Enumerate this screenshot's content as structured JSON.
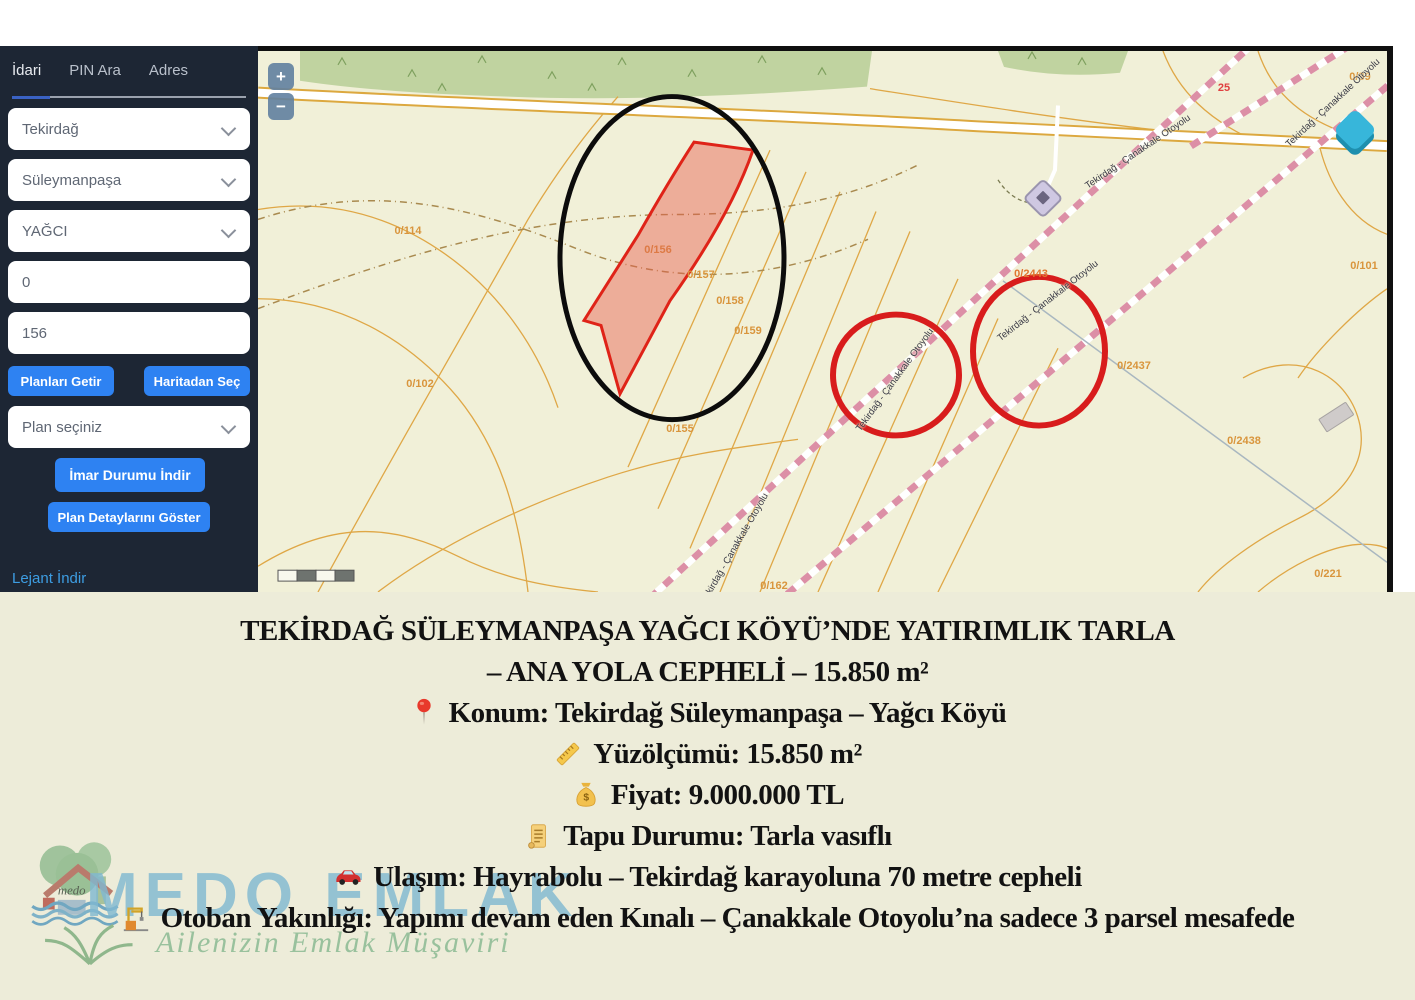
{
  "sidebar": {
    "tabs": [
      {
        "label": "İdari",
        "active": true
      },
      {
        "label": "PIN Ara",
        "active": false
      },
      {
        "label": "Adres",
        "active": false
      }
    ],
    "selects": [
      {
        "value": "Tekirdağ"
      },
      {
        "value": "Süleymanpaşa"
      },
      {
        "value": "YAĞCI"
      }
    ],
    "inputs": [
      {
        "value": "0"
      },
      {
        "value": "156"
      }
    ],
    "buttons": {
      "get_plans": "Planları Getir",
      "pick_from_map": "Haritadan Seç",
      "plan_select_placeholder": "Plan seçiniz",
      "download_zoning": "İmar Durumu İndir",
      "show_plan_details": "Plan Detaylarını Göster",
      "download_legend": "Lejant İndir"
    }
  },
  "map": {
    "controls": {
      "zoom_in": "+",
      "zoom_out": "−"
    },
    "parcel_labels": [
      {
        "text": "0/114",
        "x": 150,
        "y": 180
      },
      {
        "text": "0/102",
        "x": 162,
        "y": 333
      },
      {
        "text": "0/156",
        "x": 400,
        "y": 199,
        "color": "#dd7a45"
      },
      {
        "text": "0/157",
        "x": 443,
        "y": 224
      },
      {
        "text": "0/158",
        "x": 472,
        "y": 250
      },
      {
        "text": "0/159",
        "x": 490,
        "y": 280
      },
      {
        "text": "0/155",
        "x": 422,
        "y": 378
      },
      {
        "text": "0/162",
        "x": 516,
        "y": 535
      },
      {
        "text": "0/2443",
        "x": 773,
        "y": 223,
        "color": "#e0762f"
      },
      {
        "text": "0/2437",
        "x": 876,
        "y": 315
      },
      {
        "text": "0/2438",
        "x": 986,
        "y": 390
      },
      {
        "text": "0/221",
        "x": 1070,
        "y": 523
      },
      {
        "text": "0/101",
        "x": 1106,
        "y": 215
      },
      {
        "text": "0/39",
        "x": 1102,
        "y": 26
      },
      {
        "text": "25",
        "x": 966,
        "y": 37,
        "color": "#e04040"
      }
    ],
    "road_labels": [
      {
        "text": "Tekirdağ - Çanakkale Otoyolu",
        "x": 637,
        "y": 329,
        "rot": -54
      },
      {
        "text": "Tekirdağ - Çanakkale Otoyolu",
        "x": 790,
        "y": 250,
        "rot": -38
      },
      {
        "text": "Tekirdağ - Çanakkale Otoyolu",
        "x": 880,
        "y": 101,
        "rot": -34
      },
      {
        "text": "Tekirdağ - Çanakkale Otoyolu",
        "x": 1075,
        "y": 52,
        "rot": -43
      },
      {
        "text": "Tekirdağ - Çanakkale Otoyolu",
        "x": 477,
        "y": 497,
        "rot": -60
      }
    ],
    "colors": {
      "base": "#f1f0d8",
      "forest": "#c0d3a0",
      "parcel_line": "#dfa746",
      "parcel_label": "#d9953c",
      "highlight_fill": "rgba(232,92,78,0.45)",
      "highlight_stroke": "#df2318",
      "annotation_black": "#0c0c0c",
      "annotation_red": "#d81c1c",
      "construction_dash": "#dc8fa6"
    }
  },
  "listing": {
    "lines": [
      {
        "icon": null,
        "text": "TEKİRDAĞ SÜLEYMANPAŞA YAĞCI KÖYÜ’NDE YATIRIMLIK TARLA"
      },
      {
        "icon": null,
        "text": "– ANA YOLA CEPHELİ – 15.850 m²"
      },
      {
        "icon": "pin",
        "text": "Konum: Tekirdağ Süleymanpaşa – Yağcı Köyü"
      },
      {
        "icon": "ruler",
        "text": "Yüzölçümü: 15.850 m²"
      },
      {
        "icon": "money-bag",
        "text": "Fiyat: 9.000.000 TL"
      },
      {
        "icon": "scroll",
        "text": "Tapu Durumu: Tarla vasıflı"
      },
      {
        "icon": "car",
        "text": "Ulaşım: Hayrabolu – Tekirdağ karayoluna 70 metre cepheli"
      },
      {
        "icon": "construction-crane",
        "text": "Otoban Yakınlığı: Yapımı devam eden Kınalı – Çanakkale Otoyolu’na sadece 3 parsel mesafede"
      }
    ]
  },
  "watermark": {
    "brand": "MEDO EMLAK",
    "tagline": "Ailenizin Emlak Müşaviri",
    "logo_script": "medo"
  }
}
